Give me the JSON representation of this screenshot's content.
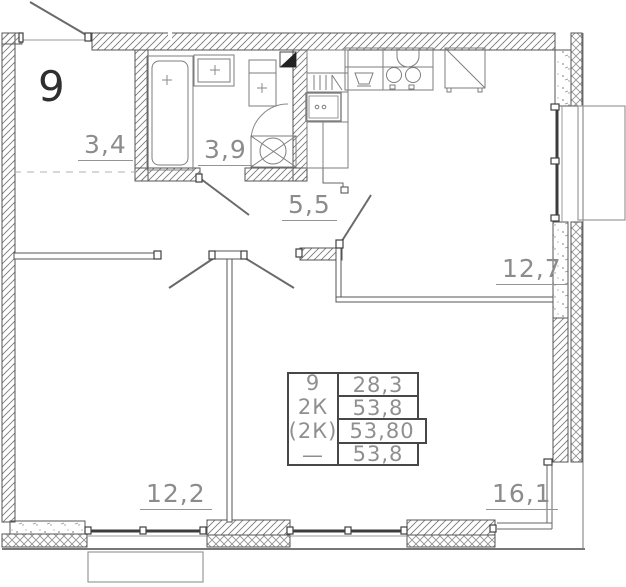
{
  "plan": {
    "apartment_number": "9",
    "rooms": [
      {
        "id": "entry-hall",
        "area": "3,4"
      },
      {
        "id": "bathroom",
        "area": "3,9"
      },
      {
        "id": "inner-hall",
        "area": "5,5"
      },
      {
        "id": "kitchen-living",
        "area": "12,7"
      },
      {
        "id": "room-left",
        "area": "12,2"
      },
      {
        "id": "room-right",
        "area": "16,1"
      }
    ],
    "stamp_table": {
      "left_rows": [
        "9",
        "2К",
        "(2К)",
        "—"
      ],
      "right_rows": [
        "28,3",
        "53,8",
        "53,80",
        "53,8"
      ]
    },
    "colors": {
      "line": "#555555",
      "label": "#8c8c8c",
      "window_glass": "#3c3c3c"
    }
  }
}
